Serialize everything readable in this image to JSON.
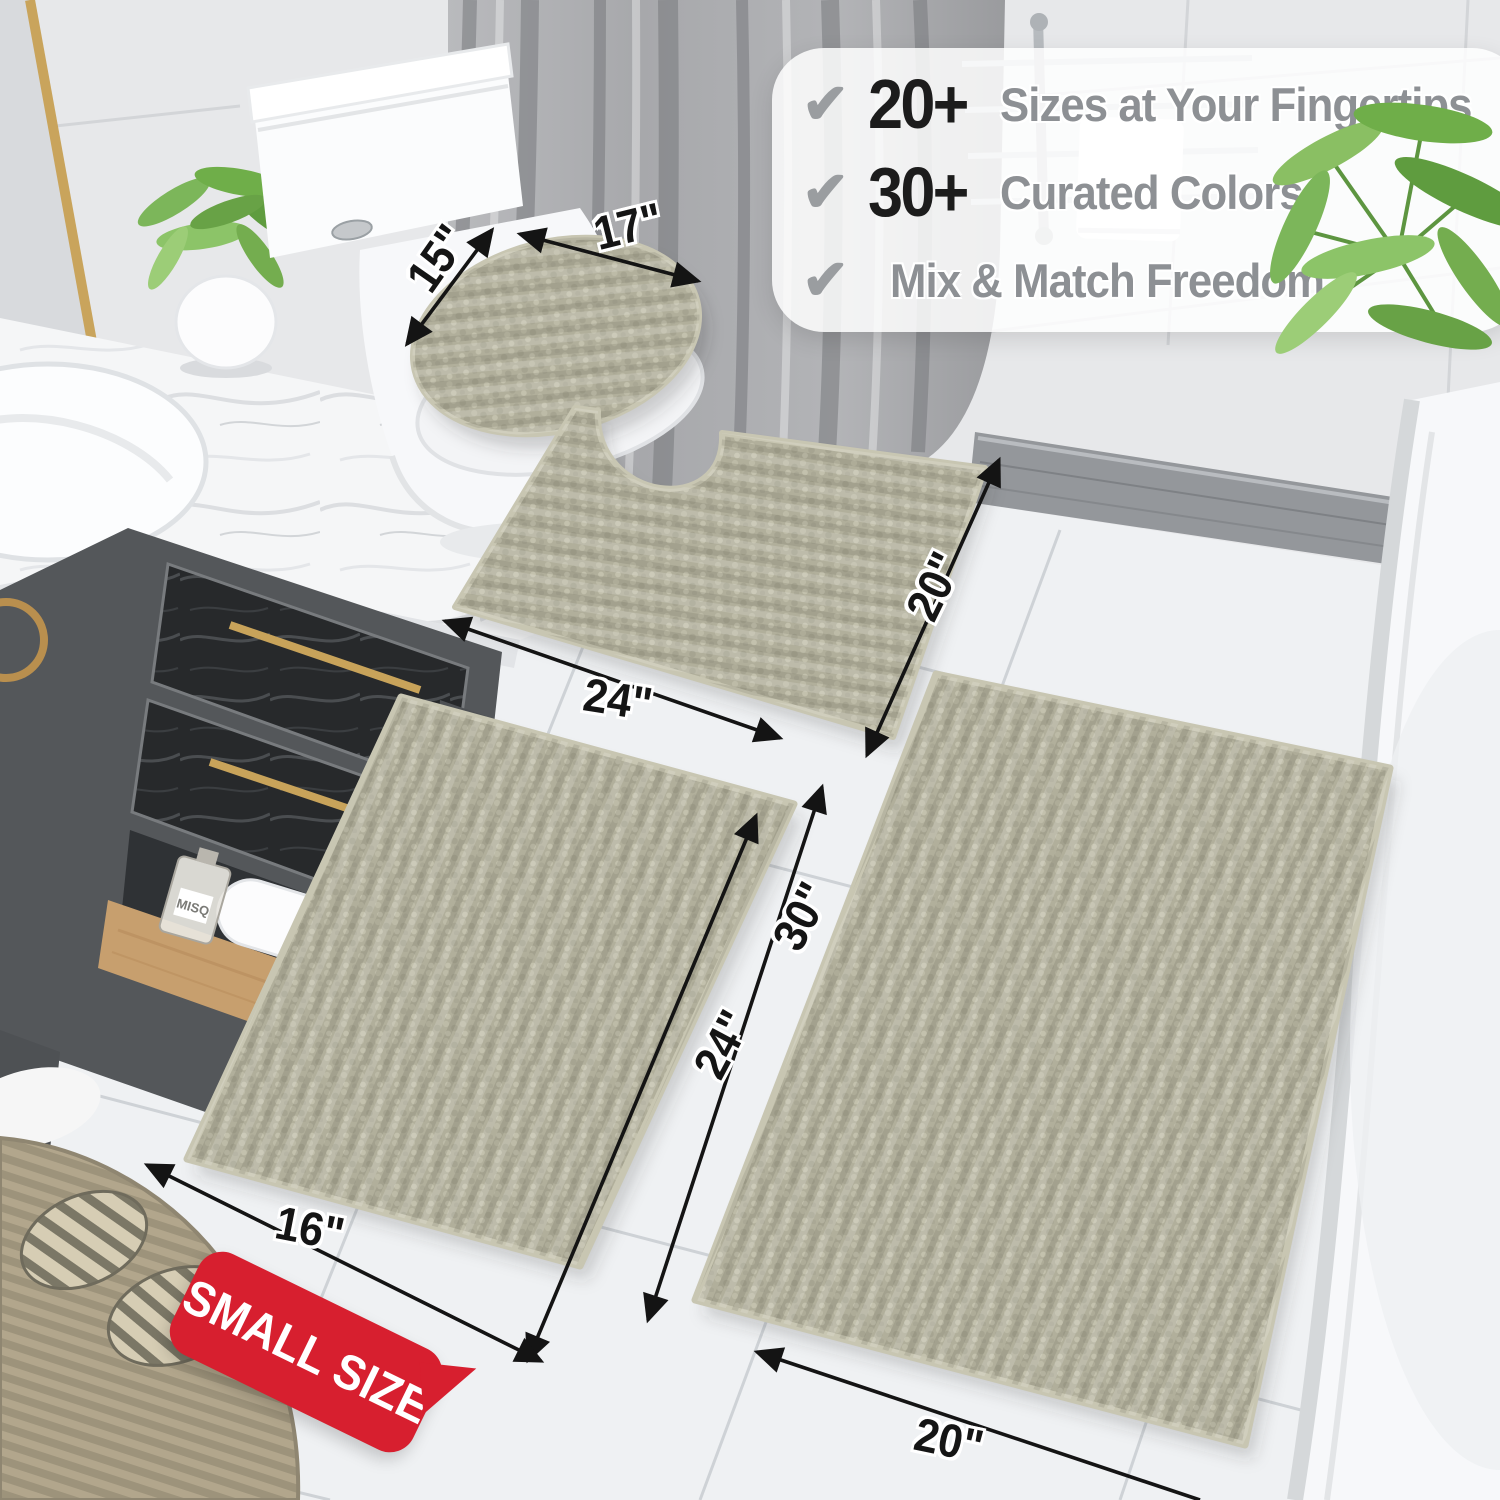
{
  "product": {
    "kind": "chenille bath rug 3-piece set product photo",
    "rug_color_hex": "#b1af9b",
    "badge_red_hex": "#d71f2f",
    "accent_black_hex": "#1c1c1c",
    "text_grey_hex": "#8d9094"
  },
  "callout": {
    "check": "✔",
    "items": [
      {
        "stat": "20+",
        "label": "Sizes at Your Fingertips"
      },
      {
        "stat": "30+",
        "label": "Curated Colors"
      },
      {
        "stat": "",
        "label": "Mix & Match Freedom"
      }
    ]
  },
  "dimension_labels": [
    {
      "id": "lid-width",
      "text": "15\""
    },
    {
      "id": "lid-length",
      "text": "17\""
    },
    {
      "id": "contour-length",
      "text": "24\""
    },
    {
      "id": "contour-depth",
      "text": "20\""
    },
    {
      "id": "runner-length",
      "text": "30\""
    },
    {
      "id": "middle-length",
      "text": "24\""
    },
    {
      "id": "small-rug-width",
      "text": "16\""
    },
    {
      "id": "large-rug-width",
      "text": "20\""
    }
  ],
  "badge": {
    "text": "SMALL SIZE"
  },
  "vanity": {
    "bottle_label": "MISQ"
  }
}
